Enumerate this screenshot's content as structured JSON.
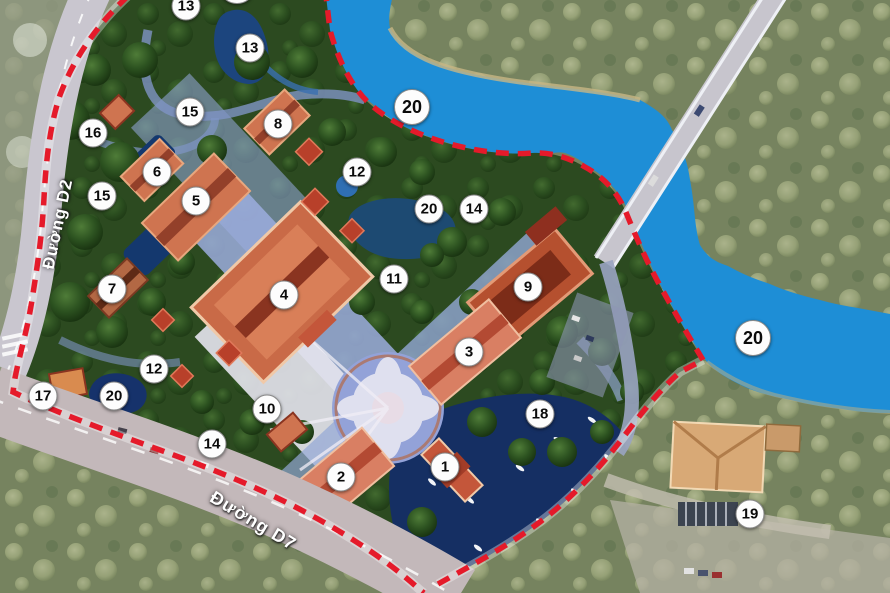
{
  "map_title": "temple-complex-master-plan",
  "roads": {
    "d2": "Đường D2",
    "d7": "Đường D7"
  },
  "markers": [
    "13",
    "13",
    "15",
    "16",
    "8",
    "20",
    "12",
    "6",
    "5",
    "15",
    "20",
    "14",
    "12",
    "7",
    "4",
    "11",
    "9",
    "20",
    "3",
    "18",
    "17",
    "20",
    "10",
    "14",
    "1",
    "2",
    "19"
  ],
  "colors": {
    "river": "#1e8ed6",
    "boundary_red": "#e51a2a",
    "park_green": "#2c4a20",
    "roof_orange": "#c96a47",
    "pond_navy": "#16316b",
    "road_gray": "#c5c0c8",
    "marker_bg": "#fdfdfd",
    "marker_text": "#0b0b0b"
  }
}
